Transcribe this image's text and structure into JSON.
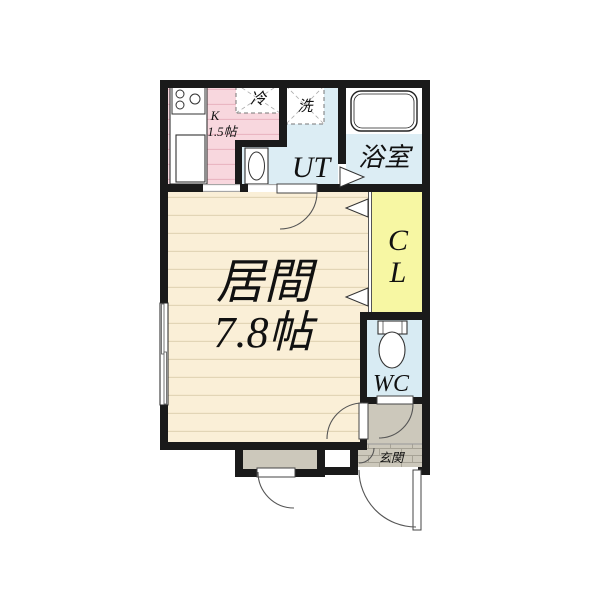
{
  "floorplan": {
    "rooms": {
      "kitchen": {
        "label": "K",
        "size": "1.5帖",
        "color": "#f8d7de"
      },
      "utility": {
        "label": "UT",
        "color": "#dcedf4"
      },
      "bathroom": {
        "label": "浴室",
        "color": "#dcedf4"
      },
      "living": {
        "label": "居間",
        "size": "7.8帖",
        "color": "#faefd7"
      },
      "closet": {
        "label_top": "C",
        "label_bottom": "L",
        "color": "#f7f7a3"
      },
      "wc": {
        "label": "WC",
        "color": "#d8ebf3"
      },
      "entrance": {
        "label": "玄関",
        "color": "#ccc8bb"
      }
    },
    "fixtures": {
      "refrigerator_label": "冷",
      "washer_label": "洗"
    },
    "icons": {
      "stove-icon": "three burner circles on counter",
      "kitchen-sink-icon": "rectangle basin",
      "bathtub-icon": "rounded rectangle tub",
      "toilet-icon": "tank rectangle with oval bowl",
      "washbasin-icon": "rectangle with oval bowl",
      "refrigerator-space": "dashed square with diagonals",
      "washer-space": "dashed square with diagonals"
    },
    "colors": {
      "wall": "#1a1a1a",
      "background": "#ffffff",
      "hall_floor": "#ccc8bb",
      "living_stripe": "#e2d5b6",
      "kitchen_stripe": "#eab4c1"
    }
  }
}
